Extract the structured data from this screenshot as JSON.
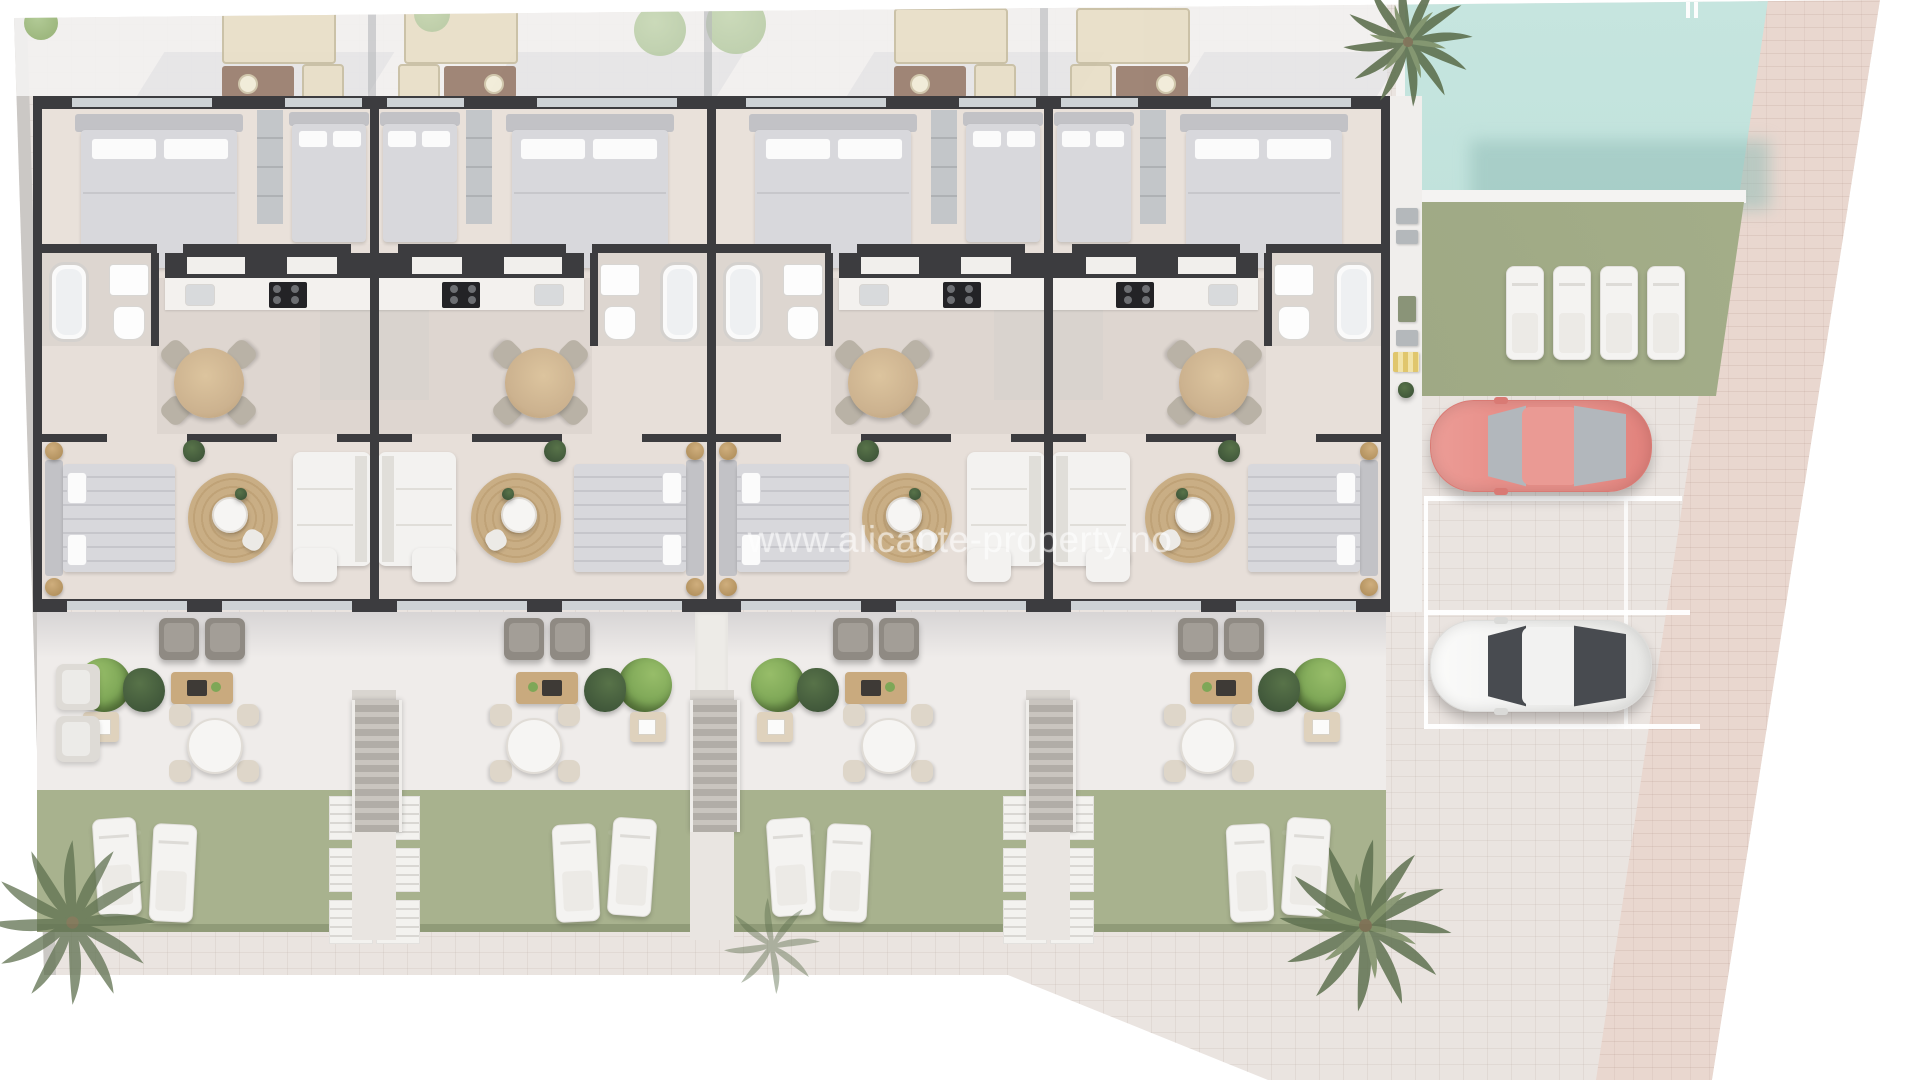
{
  "watermark": {
    "text": "www.alicante-property.no"
  },
  "scene": {
    "type": "architectural-floor-plan",
    "description": "Aerial 3D render: row of 4 mirrored ground-floor apartments with private terraces and gardens, communal pool, sunbathing lawn and parking",
    "units": [
      {
        "id": "unit-1",
        "mirrored": false
      },
      {
        "id": "unit-2",
        "mirrored": true
      },
      {
        "id": "unit-3",
        "mirrored": false
      },
      {
        "id": "unit-4",
        "mirrored": true
      }
    ],
    "pool": {
      "name": "swimming-pool"
    },
    "communal_lawn_loungers": 4,
    "garden_loungers_per_unit": 2,
    "parking": {
      "stalls": 3,
      "cars": [
        {
          "name": "red-car",
          "color": "#e8908a"
        },
        {
          "name": "white-car",
          "color": "#f5f5f4"
        }
      ]
    },
    "palm_trees": 4
  },
  "colors": {
    "wall": "#3c3c3f",
    "floor": "#e7dfd9",
    "floor2": "#ded6d0",
    "plaza": "#eae4e0",
    "plazaline": "rgba(176,160,152,0.16)",
    "band": "#e9d7cf",
    "curb": "#cbc8c5",
    "terrace": "#efecea",
    "lawn": "#a8b28e",
    "lawn2": "#a5af8a",
    "lawnDark": "#8a9573",
    "pool": "#b7ddd6",
    "poolDeep": "#93beb8",
    "white": "#f4f3f1",
    "bed": "#d8d8dc",
    "headboard": "#c2c2c6",
    "wardrobe": "#c3c6c9",
    "jute": "#b3925f",
    "rug": "#c9ae85",
    "sofa": "#f3f2f0",
    "armchair": "#8f8a83",
    "wood": "#c9aa7e",
    "woodDark": "#3e3a36",
    "plant": "#5d7a4a",
    "bush": "#7ea757",
    "palm": "#5f7150",
    "palmLight": "#7d8f66",
    "carRed": "#e8908a",
    "carWhite": "#f5f5f4",
    "glassLight": "#b2b7bc",
    "glassDark": "#484b50",
    "acGray": "#b4b8bb",
    "chairBeige": "#b9b2a6",
    "tableWood": "#ccb28f",
    "divider": "#b6b7ba",
    "setBeige": "#e8dfc8",
    "setBrown": "#9b8070",
    "treeFaded": "#b7cba4"
  }
}
